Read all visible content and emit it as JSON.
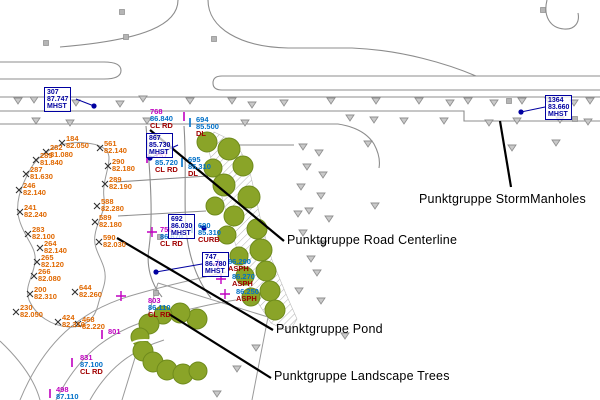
{
  "figure": {
    "type": "CAD site plan viewport (survey point groups)",
    "language": "German labels: Punktgruppe = point group"
  },
  "colors": {
    "pond_text": "#e06800",
    "point_number": "#c000c0",
    "elevation_text": "#0070c8",
    "description_text": "#a00000",
    "manhole_text": "#0000a0",
    "tree_fill": "#8aa428",
    "tree_edge": "#6e8a1c",
    "linework": "#8c8c8c",
    "triangle": "#8f8f8f",
    "annotation_text": "#000000",
    "leader_line": "#000000"
  },
  "annotations": [
    {
      "id": "storm-manholes",
      "label": "Punktgruppe StormManholes",
      "text_pos": [
        419,
        192
      ],
      "leader": [
        [
          500,
          121
        ],
        [
          511,
          187
        ]
      ]
    },
    {
      "id": "road-centerline",
      "label": "Punktgruppe Road Centerline",
      "text_pos": [
        287,
        233
      ],
      "leader": [
        [
          150,
          130
        ],
        [
          284,
          241
        ]
      ]
    },
    {
      "id": "pond",
      "label": "Punktgruppe Pond",
      "text_pos": [
        276,
        322
      ],
      "leader": [
        [
          117,
          238
        ],
        [
          273,
          330
        ]
      ]
    },
    {
      "id": "landscape-trees",
      "label": "Punktgruppe Landscape Trees",
      "text_pos": [
        274,
        369
      ],
      "leader": [
        [
          169,
          314
        ],
        [
          271,
          378
        ]
      ]
    }
  ],
  "point_groups": {
    "storm_manholes": {
      "name": "StormManholes",
      "points": [
        {
          "num": "307",
          "elev": "87.747",
          "desc": "MHST",
          "box": [
            44,
            87
          ],
          "marker": [
            94,
            106
          ]
        },
        {
          "num": "867",
          "elev": "85.730",
          "desc": "MHST",
          "box": [
            146,
            133
          ],
          "marker": [
            150,
            158
          ]
        },
        {
          "num": "692",
          "elev": "86.030",
          "desc": "MHST",
          "box": [
            168,
            214
          ],
          "marker": [
            204,
            228
          ]
        },
        {
          "num": "747",
          "elev": "86.780",
          "desc": "MHST",
          "box": [
            202,
            252
          ],
          "marker": [
            156,
            272
          ]
        },
        {
          "num": "1364",
          "elev": "83.660",
          "desc": "MHST",
          "box": [
            545,
            95
          ],
          "marker": [
            521,
            112
          ]
        }
      ]
    },
    "road_centerline": {
      "name": "Road Centerline",
      "points": [
        {
          "num": "768",
          "elev": "86.840",
          "desc": "CL RD",
          "pos": [
            150,
            108
          ],
          "marker": "tick",
          "marker_pos": [
            184,
            116
          ]
        },
        {
          "num": "757",
          "elev": "85.720",
          "desc": "CL RD",
          "pos": [
            155,
            152
          ],
          "marker": "tick",
          "marker_pos": [
            147,
            158
          ]
        },
        {
          "num": "756",
          "elev": "86.670",
          "desc": "CL RD",
          "pos": [
            160,
            226
          ],
          "marker": "cross",
          "marker_pos": [
            152,
            232
          ]
        },
        {
          "num": "803",
          "elev": "86.110",
          "desc": "CL RD",
          "pos": [
            148,
            297
          ],
          "marker": "cross",
          "marker_pos": [
            121,
            296
          ]
        },
        {
          "num": "801",
          "elev": "",
          "desc": "",
          "pos": [
            108,
            328
          ],
          "marker": "tick",
          "marker_pos": [
            102,
            334
          ]
        },
        {
          "num": "831",
          "elev": "87.100",
          "desc": "CL RD",
          "pos": [
            80,
            354
          ],
          "marker": "tick",
          "marker_pos": [
            72,
            362
          ]
        },
        {
          "num": "498",
          "elev": "87.110",
          "desc": "",
          "pos": [
            56,
            386
          ],
          "marker": "tick",
          "marker_pos": [
            50,
            393
          ]
        }
      ]
    },
    "curb_asphalt": {
      "name": "Curb / Asphalt shots",
      "points": [
        {
          "num": "694",
          "elev": "85.500",
          "desc": "DL",
          "num_color": "blue",
          "pos": [
            196,
            116
          ],
          "marker": "tick-blue",
          "marker_pos": [
            190,
            122
          ]
        },
        {
          "num": "695",
          "elev": "85.310",
          "desc": "DL",
          "num_color": "blue",
          "pos": [
            188,
            156
          ],
          "marker": "tick-blue",
          "marker_pos": [
            182,
            162
          ]
        },
        {
          "num": "690",
          "elev": "85.310",
          "desc": "CURB",
          "num_color": "blue",
          "pos": [
            198,
            222
          ],
          "marker": "tick-blue",
          "marker_pos": [
            192,
            228
          ]
        },
        {
          "num": "",
          "elev": "86.290",
          "desc": "ASPH",
          "pos": [
            228,
            258
          ],
          "marker": "cross",
          "marker_pos": [
            218,
            264
          ]
        },
        {
          "num": "",
          "elev": "86.270",
          "desc": "ASPH",
          "pos": [
            232,
            273
          ],
          "marker": "cross",
          "marker_pos": [
            221,
            279
          ]
        },
        {
          "num": "",
          "elev": "86.250",
          "desc": "ASPH",
          "pos": [
            236,
            288
          ],
          "marker": "cross",
          "marker_pos": [
            225,
            294
          ]
        }
      ]
    },
    "pond": {
      "name": "Pond",
      "points": [
        {
          "num": "184",
          "elev": "82.050",
          "m": [
            62,
            143
          ]
        },
        {
          "num": "282",
          "elev": "81.080",
          "m": [
            46,
            152
          ]
        },
        {
          "num": "285",
          "elev": "81.840",
          "m": [
            36,
            160
          ]
        },
        {
          "num": "287",
          "elev": "81.630",
          "m": [
            26,
            174
          ]
        },
        {
          "num": "246",
          "elev": "82.140",
          "m": [
            19,
            190
          ]
        },
        {
          "num": "241",
          "elev": "82.240",
          "m": [
            20,
            212
          ]
        },
        {
          "num": "283",
          "elev": "82.100",
          "m": [
            28,
            234
          ]
        },
        {
          "num": "264",
          "elev": "82.140",
          "m": [
            40,
            248
          ]
        },
        {
          "num": "265",
          "elev": "82.120",
          "m": [
            37,
            262
          ]
        },
        {
          "num": "266",
          "elev": "82.080",
          "m": [
            34,
            276
          ]
        },
        {
          "num": "200",
          "elev": "82.310",
          "m": [
            30,
            294
          ]
        },
        {
          "num": "230",
          "elev": "82.050",
          "m": [
            16,
            312
          ]
        },
        {
          "num": "424",
          "elev": "82.310",
          "m": [
            58,
            322
          ]
        },
        {
          "num": "468",
          "elev": "82.220",
          "m": [
            78,
            324
          ]
        },
        {
          "num": "561",
          "elev": "82.140",
          "m": [
            100,
            148
          ]
        },
        {
          "num": "290",
          "elev": "82.180",
          "m": [
            108,
            166
          ]
        },
        {
          "num": "289",
          "elev": "82.190",
          "m": [
            105,
            184
          ]
        },
        {
          "num": "588",
          "elev": "82.280",
          "m": [
            97,
            206
          ]
        },
        {
          "num": "589",
          "elev": "82.180",
          "m": [
            95,
            222
          ]
        },
        {
          "num": "590",
          "elev": "82.030",
          "m": [
            99,
            242
          ]
        },
        {
          "num": "644",
          "elev": "82.260",
          "m": [
            75,
            292
          ]
        }
      ]
    }
  },
  "map": {
    "trees": [
      [
        207,
        142,
        10
      ],
      [
        229,
        149,
        11
      ],
      [
        243,
        166,
        10
      ],
      [
        213,
        168,
        9
      ],
      [
        224,
        185,
        11
      ],
      [
        249,
        197,
        11
      ],
      [
        215,
        206,
        9
      ],
      [
        234,
        216,
        10
      ],
      [
        257,
        229,
        10
      ],
      [
        227,
        235,
        9
      ],
      [
        261,
        250,
        11
      ],
      [
        239,
        256,
        9
      ],
      [
        266,
        271,
        10
      ],
      [
        245,
        276,
        9
      ],
      [
        270,
        291,
        10
      ],
      [
        251,
        297,
        9
      ],
      [
        275,
        310,
        10
      ],
      [
        197,
        319,
        10
      ],
      [
        180,
        313,
        10
      ],
      [
        163,
        315,
        9
      ],
      [
        149,
        324,
        10
      ],
      [
        140,
        337,
        9
      ],
      [
        143,
        351,
        10
      ],
      [
        153,
        362,
        10
      ],
      [
        167,
        370,
        10
      ],
      [
        183,
        374,
        10
      ],
      [
        198,
        371,
        9
      ]
    ],
    "triangles": [
      [
        18,
        101
      ],
      [
        34,
        100
      ],
      [
        76,
        103
      ],
      [
        120,
        104
      ],
      [
        143,
        99
      ],
      [
        190,
        101
      ],
      [
        232,
        101
      ],
      [
        252,
        105
      ],
      [
        284,
        103
      ],
      [
        331,
        101
      ],
      [
        376,
        101
      ],
      [
        419,
        101
      ],
      [
        450,
        103
      ],
      [
        468,
        101
      ],
      [
        494,
        103
      ],
      [
        522,
        101
      ],
      [
        549,
        101
      ],
      [
        574,
        103
      ],
      [
        590,
        101
      ],
      [
        36,
        121
      ],
      [
        70,
        123
      ],
      [
        147,
        121
      ],
      [
        245,
        123
      ],
      [
        350,
        118
      ],
      [
        374,
        120
      ],
      [
        404,
        121
      ],
      [
        444,
        121
      ],
      [
        489,
        123
      ],
      [
        517,
        121
      ],
      [
        560,
        120
      ],
      [
        588,
        122
      ],
      [
        368,
        144
      ],
      [
        512,
        148
      ],
      [
        556,
        143
      ],
      [
        303,
        147
      ],
      [
        319,
        153
      ],
      [
        307,
        167
      ],
      [
        323,
        175
      ],
      [
        301,
        187
      ],
      [
        321,
        196
      ],
      [
        309,
        211
      ],
      [
        329,
        219
      ],
      [
        303,
        233
      ],
      [
        323,
        244
      ],
      [
        311,
        259
      ],
      [
        317,
        273
      ],
      [
        299,
        291
      ],
      [
        321,
        301
      ],
      [
        298,
        214
      ],
      [
        375,
        206
      ],
      [
        345,
        336
      ],
      [
        256,
        348
      ],
      [
        237,
        369
      ],
      [
        217,
        394
      ]
    ],
    "squares": [
      [
        46,
        43
      ],
      [
        126,
        37
      ],
      [
        122,
        12
      ],
      [
        214,
        39
      ],
      [
        543,
        10
      ],
      [
        509,
        101
      ],
      [
        160,
        237
      ],
      [
        156,
        293
      ],
      [
        575,
        119
      ]
    ]
  }
}
